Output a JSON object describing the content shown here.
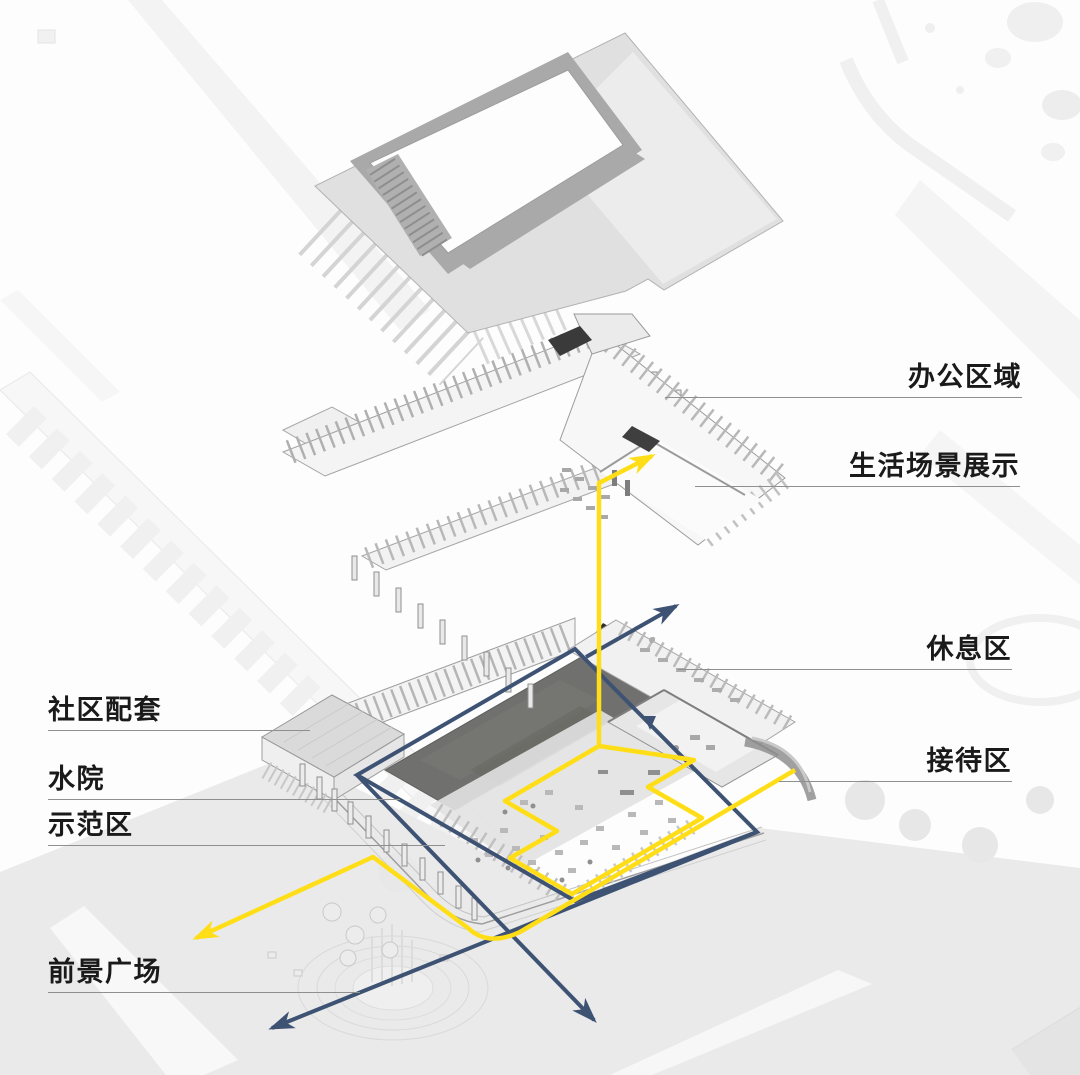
{
  "page": {
    "background": "#fdfdfd"
  },
  "colors": {
    "route_yellow": "#FFDE17",
    "route_blue": "#3E5373",
    "label_text": "#1A1A1A",
    "leader_line": "#8F8F8F",
    "water_fill": "#70706E",
    "roof_band": "#A9A9A9",
    "canopy_dark": "#2F2F2F"
  },
  "annotations": {
    "right_labels": [
      {
        "id": "office-area",
        "text": "办公区域"
      },
      {
        "id": "life-scene-display",
        "text": "生活场景展示"
      },
      {
        "id": "rest-area",
        "text": "休息区"
      },
      {
        "id": "reception-area",
        "text": "接待区"
      }
    ],
    "left_labels": [
      {
        "id": "community-facilities",
        "text": "社区配套"
      },
      {
        "id": "water-courtyard",
        "text": "水院"
      },
      {
        "id": "demonstration-area",
        "text": "示范区"
      },
      {
        "id": "foreground-plaza",
        "text": "前景广场"
      }
    ]
  }
}
